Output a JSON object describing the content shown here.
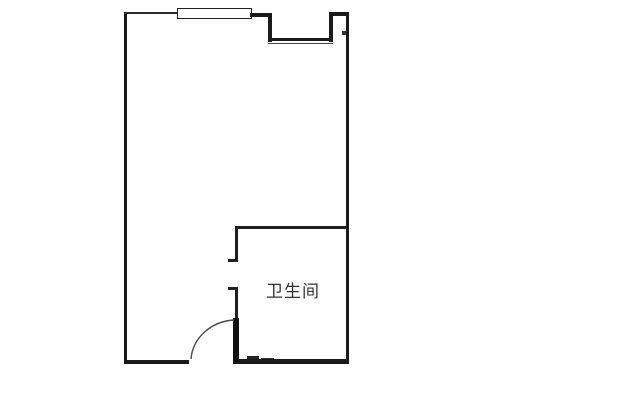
{
  "floor_plan": {
    "room_labels": [
      {
        "text": "卫生间"
      }
    ],
    "symbols": [
      "window-symbol",
      "entry-door-swing",
      "bathroom-doorway",
      "wall-notch"
    ],
    "colors": {
      "wall": "#1a1a1a",
      "background": "#ffffff",
      "label_text": "#333333"
    }
  }
}
